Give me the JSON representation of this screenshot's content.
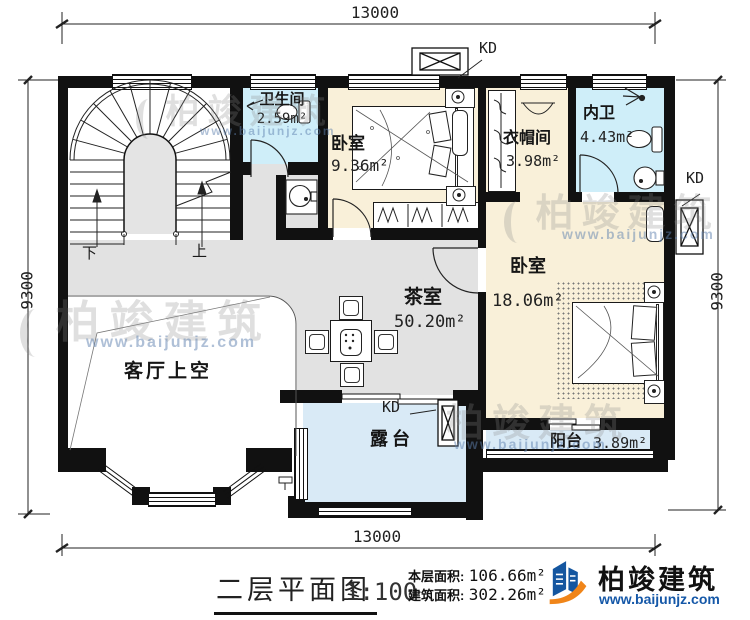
{
  "plan": {
    "dimensions": {
      "top": "13000",
      "bottom": "13000",
      "left": "9300",
      "right": "9300"
    },
    "rooms": {
      "bath1": {
        "name": "卫生间",
        "area": "2.59m²"
      },
      "bedroom1": {
        "name": "卧室",
        "area": "9.36m²"
      },
      "cloakroom": {
        "name": "衣帽间",
        "area": "3.98m²"
      },
      "bath2": {
        "name": "内卫",
        "area": "4.43m²"
      },
      "bedroom2": {
        "name": "卧室",
        "area": "18.06m²"
      },
      "tearoom": {
        "name": "茶室",
        "area": "50.20m²"
      },
      "void": {
        "name": "客厅上空"
      },
      "terrace": {
        "name": "露台"
      },
      "balcony": {
        "name": "阳台",
        "area": "3.89m²"
      }
    },
    "stairs": {
      "down": "下",
      "up": "上"
    },
    "ac_labels": {
      "top": "KD",
      "right": "KD",
      "terrace": "KD"
    }
  },
  "title_block": {
    "title": "二层平面图",
    "scale": "1:100",
    "floor_area_label": "本层面积:",
    "floor_area_value": "106.66m²",
    "gross_area_label": "建筑面积:",
    "gross_area_value": "302.26m²"
  },
  "brand": {
    "name": "柏竣建筑",
    "url": "www.baijunjz.com"
  },
  "watermark": {
    "text": "柏竣建筑",
    "url": "www.baijunjz.com"
  },
  "colors": {
    "wall": "#111111",
    "wet_room": "#cfeef9",
    "bedroom": "#f9f0d9",
    "hall": "#e2e2e2",
    "outdoor": "#d9eaf6",
    "brand_blue": "#1558a8",
    "brand_orange": "#f08519"
  }
}
